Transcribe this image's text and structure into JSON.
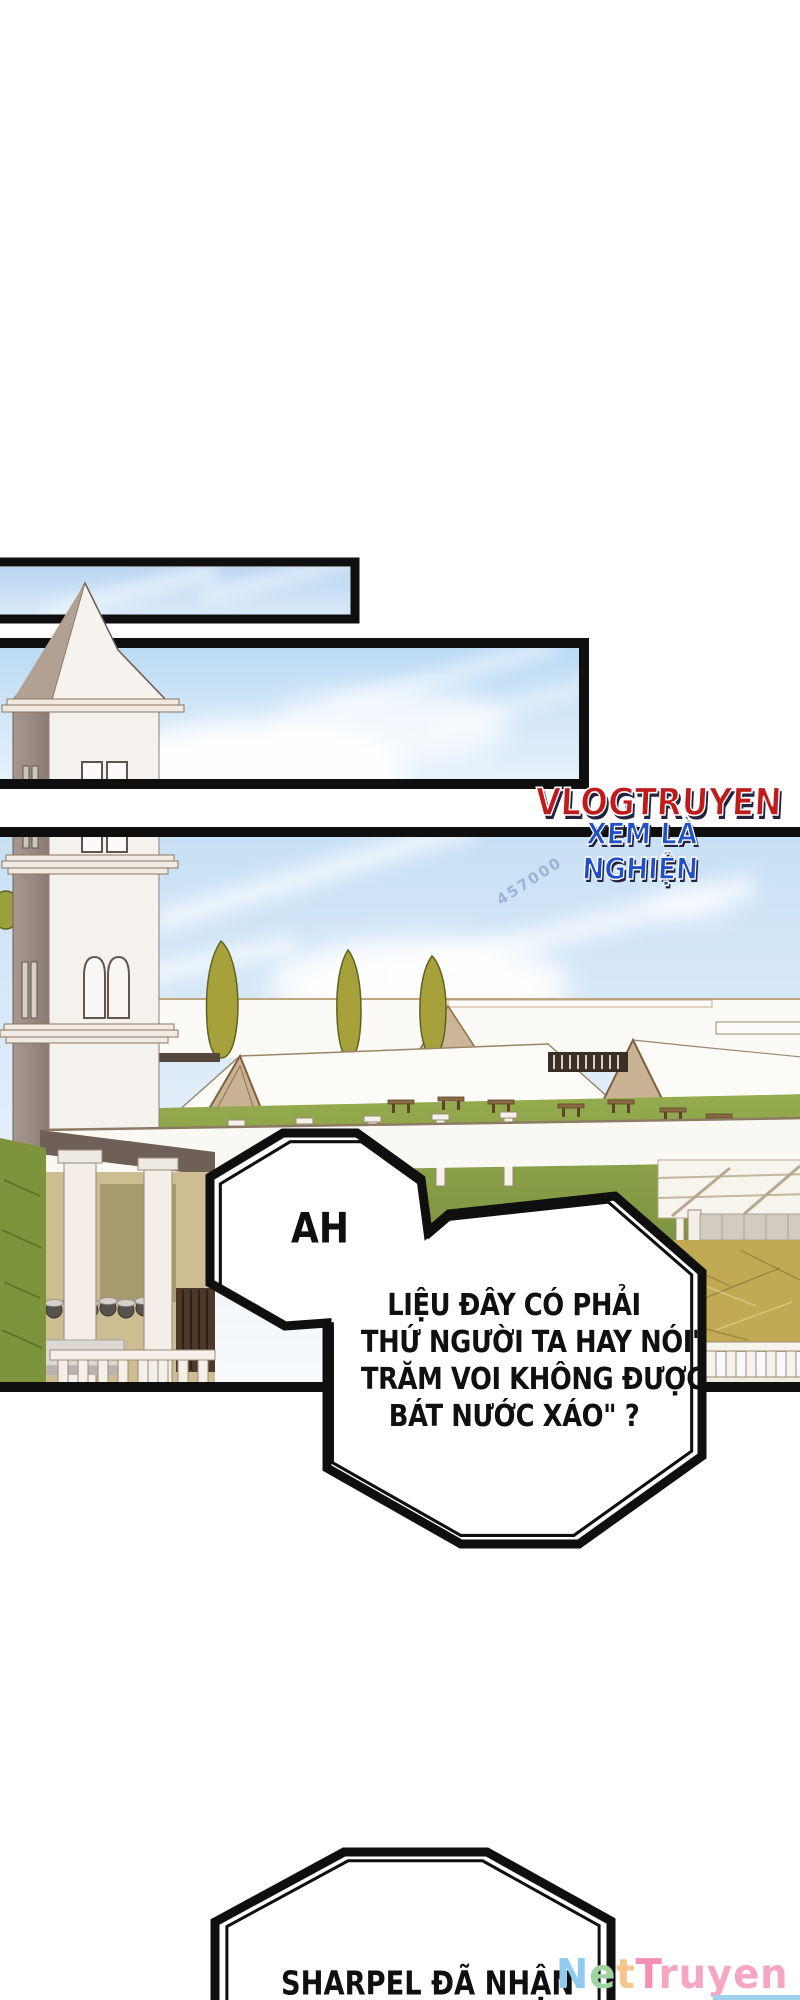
{
  "branding": {
    "site_logo": {
      "line1": "VLOGTRUYEN",
      "line2": "XEM LÀ NGHIỆN",
      "line1_color": "#bf1b1b",
      "line2_color": "#2050c8",
      "outline_color": "#ffffff",
      "shadow_color": "#23233f"
    },
    "watermark": "457000",
    "footer_logo": {
      "name": "NetTruyen",
      "letters": [
        {
          "ch": "N",
          "color": "#8ecbee"
        },
        {
          "ch": "e",
          "color": "#9fd3a0"
        },
        {
          "ch": "t",
          "color": "#f8c48e"
        },
        {
          "ch": "T",
          "color": "#f590b4"
        },
        {
          "ch": "r",
          "color": "#f5a6c2"
        },
        {
          "ch": "u",
          "color": "#f5a6c2"
        },
        {
          "ch": "y",
          "color": "#f5a6c2"
        },
        {
          "ch": "e",
          "color": "#f5a6c2"
        },
        {
          "ch": "n",
          "color": "#f5a6c2"
        }
      ]
    }
  },
  "comic": {
    "bubbles": {
      "exclaim": {
        "text": "AH"
      },
      "question": {
        "lines": [
          "LIỆU ĐÂY CÓ PHẢI",
          "THỨ NGƯỜI TA HAY NÓI\"",
          "TRĂM VOI KHÔNG ĐƯỢC",
          "BÁT NƯỚC XÁO\" ?"
        ]
      },
      "bottom": {
        "text": "SHARPEL ĐÃ NHẬN"
      }
    },
    "scene": "white clock tower with spire, campus courtyard with gabled pavilions, cypress trees, colonnades, picnic tables and lawns under a pale blue sky"
  },
  "palette": {
    "panel_border": "#0f0f0f",
    "sky_top": "#b9d6f2",
    "sky_bottom": "#f2f8fd",
    "tower_face": "#f5f2ee",
    "tower_shadow": "#9c8d89",
    "gable_tan": "#c9b394",
    "tree_olive": "#a6a13b",
    "lawn_green": "#8ba446",
    "grass_dark": "#7e943c",
    "dirt_khaki": "#c2a953",
    "porch_tan": "#cdbd92",
    "bubble_fill": "#ffffff"
  }
}
